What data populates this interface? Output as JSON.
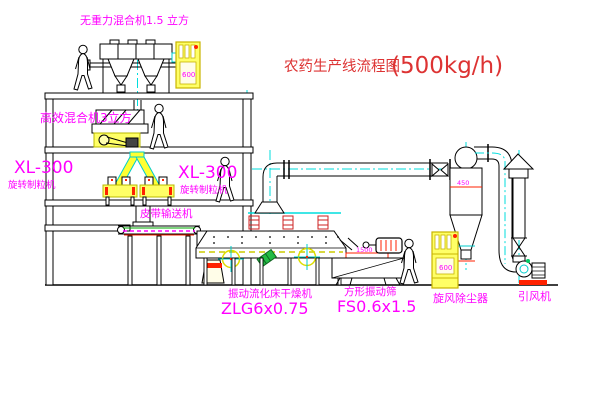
{
  "title": {
    "text": "农药生产线流程图",
    "capacity": "(500kg/h)"
  },
  "labels": {
    "top_mixer": "无重力混合机1.5 立方",
    "mid_mixer": "高效混合机3立方",
    "granulator_left_model": "XL-300",
    "granulator_left_name": "旋转制粒机",
    "granulator_right_model": "XL-300",
    "granulator_right_name": "旋转制粒机",
    "belt_conveyor": "皮带输送机",
    "dryer_name": "振动流化床干燥机",
    "dryer_model": "ZLG6x0.75",
    "sieve_name": "方形振动筛",
    "sieve_model": "FS0.6x1.5",
    "cyclone": "旋风除尘器",
    "fan": "引风机",
    "sieve_inlet_dim": "1500",
    "cyclone_dim": "450",
    "cabinet_top_mark": "600",
    "cabinet_bottom_mark": "600"
  },
  "colors": {
    "label_magenta": "#ff00ff",
    "title_red": "#dd3333",
    "equipment_yellow": "#ffff66",
    "centerline_cyan": "#00dddd",
    "line_black": "#000000",
    "accent_red": "#ff2200",
    "accent_green": "#22bb44"
  }
}
